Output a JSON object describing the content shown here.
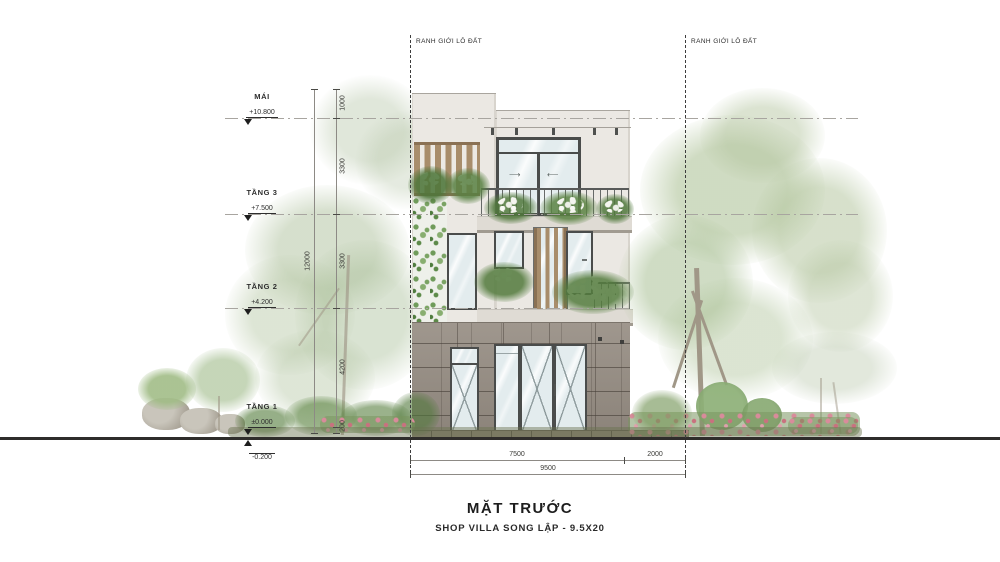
{
  "drawing": {
    "title": "MẶT TRƯỚC",
    "subtitle": "SHOP VILLA SONG LẬP  - 9.5X20"
  },
  "boundary": {
    "left": "RANH GIỚI LÔ ĐẤT",
    "right": "RANH GIỚI LÔ ĐẤT"
  },
  "levels": {
    "mai": {
      "name": "MÁI",
      "elev": "+10.800"
    },
    "tang3": {
      "name": "TẦNG 3",
      "elev": "+7.500"
    },
    "tang2": {
      "name": "TẦNG 2",
      "elev": "+4.200"
    },
    "tang1": {
      "name": "TẦNG 1",
      "elev": "±0.000"
    },
    "ground": {
      "elev": "-0.200"
    }
  },
  "dims": {
    "v_overall": "12000",
    "v_seg1": "1000",
    "v_seg2": "3300",
    "v_seg3": "3300",
    "v_seg4": "4200",
    "v_seg5": "200",
    "h_seg1": "7500",
    "h_seg2": "2000",
    "h_overall": "9500"
  }
}
